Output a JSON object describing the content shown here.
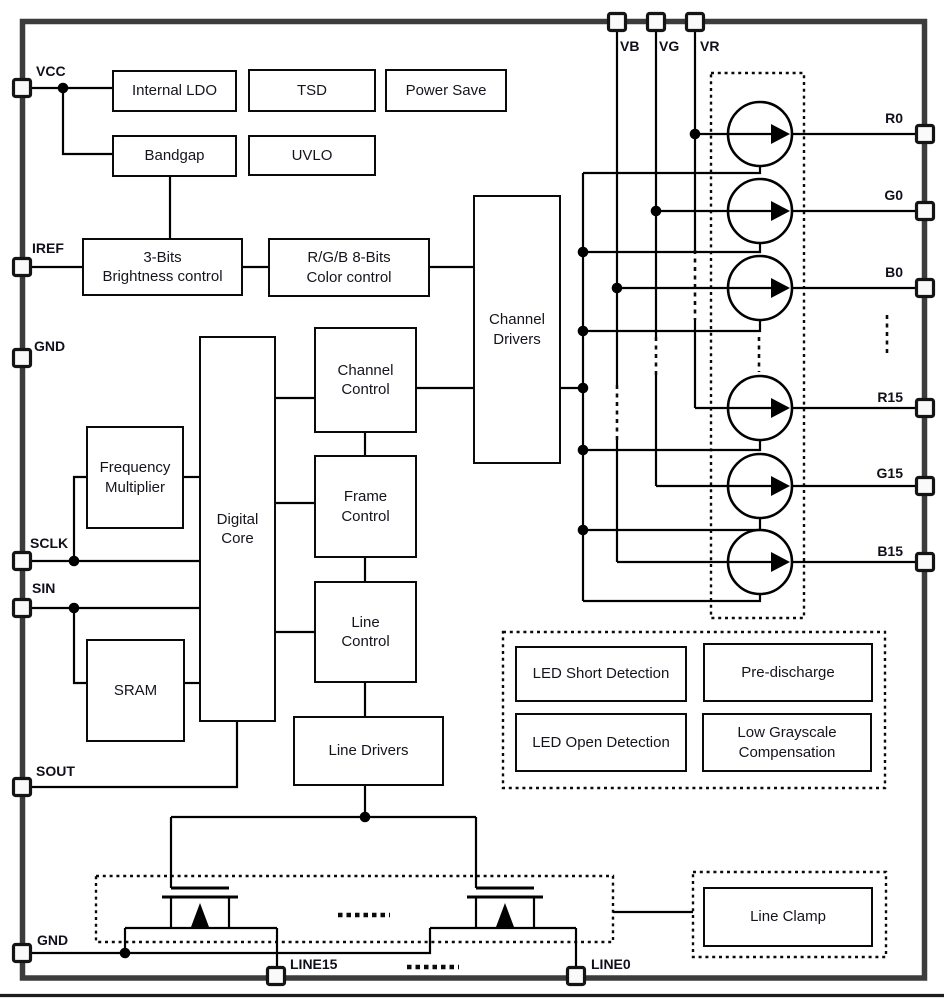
{
  "blocks": {
    "internal_ldo": "Internal LDO",
    "tsd": "TSD",
    "power_save": "Power Save",
    "bandgap": "Bandgap",
    "uvlo": "UVLO",
    "brightness_control": "3-Bits\nBrightness control",
    "color_control": "R/G/B 8-Bits\nColor control",
    "channel_drivers": "Channel\nDrivers",
    "digital_core": "Digital\nCore",
    "channel_control": "Channel\nControl",
    "frame_control": "Frame\nControl",
    "line_control": "Line\nControl",
    "frequency_multiplier": "Frequency\nMultiplier",
    "sram": "SRAM",
    "line_drivers": "Line Drivers",
    "led_short_detection": "LED Short Detection",
    "pre_discharge": "Pre-discharge",
    "led_open_detection": "LED Open Detection",
    "low_grayscale_compensation": "Low Grayscale\nCompensation",
    "line_clamp": "Line Clamp"
  },
  "pins": {
    "vcc": "VCC",
    "iref": "IREF",
    "gnd_left": "GND",
    "sclk": "SCLK",
    "sin": "SIN",
    "sout": "SOUT",
    "gnd_bottom": "GND",
    "vb": "VB",
    "vg": "VG",
    "vr": "VR",
    "r0": "R0",
    "g0": "G0",
    "b0": "B0",
    "r15": "R15",
    "g15": "G15",
    "b15": "B15",
    "line15": "LINE15",
    "line0": "LINE0"
  },
  "colors": {
    "wire_ink": "#000000",
    "chip_frame": "#3c3c3c",
    "text_ink": "#14141c",
    "background": "#ffffff"
  }
}
